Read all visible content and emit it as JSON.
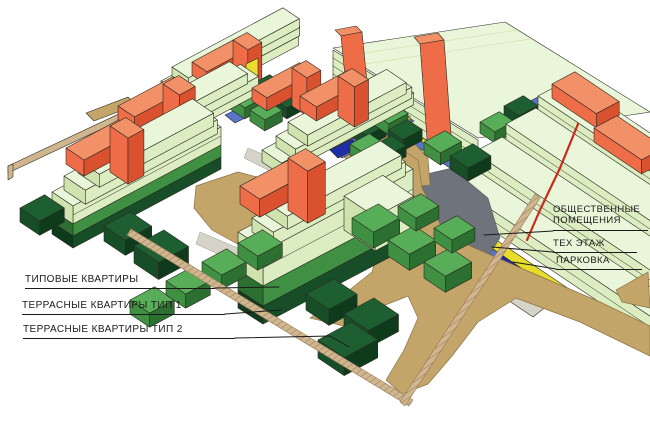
{
  "diagram": {
    "type": "axonometric-massing-scheme",
    "legend": {
      "apartments": [
        {
          "label": "ТИПОВЫЕ КВАРТИРЫ",
          "color": "#eaf6da"
        },
        {
          "label": "ТЕРРАСНЫЕ КВАРТИРЫ ТИП 1",
          "color": "#3f9043"
        },
        {
          "label": "ТЕРРАСНЫЕ КВАРТИРЫ ТИП 2",
          "color": "#174d27"
        }
      ],
      "base_levels": [
        {
          "label": "ОБЩЕСТВЕННЫЕ ПОМЕЩЕНИЯ",
          "color": "#e9dd2c"
        },
        {
          "label": "ТЕХ ЭТАЖ",
          "color": "#5a74c8"
        },
        {
          "label": "ПАРКОВКА",
          "color": "#d6d4c8"
        }
      ]
    },
    "palette": {
      "background": "#ffffff",
      "outline": "#2b2b22",
      "pale_top": "#eaf6da",
      "pale_end": "#cfe3af",
      "pale_long": "#dcedc2",
      "mid_top": "#58ae58",
      "mid_end": "#3f9043",
      "mid_long": "#2c7031",
      "dark_top": "#1e5f31",
      "dark_end": "#174d27",
      "dark_long": "#0e3b1c",
      "orange_top": "#f29067",
      "orange_end": "#ee6c48",
      "orange_long": "#d9512e",
      "yellow": "#e9dd2c",
      "blue": "#5a74c8",
      "navy": "#1e2ea6",
      "red_edge": "#cc2a1e",
      "path_tan": "#c4a569",
      "wall_tan": "#cfb68e",
      "wall_hatch": "#97765a",
      "grey_dark": "#6e737c",
      "grey_light": "#d6d4c8",
      "label_color": "#1a1a1a"
    }
  }
}
